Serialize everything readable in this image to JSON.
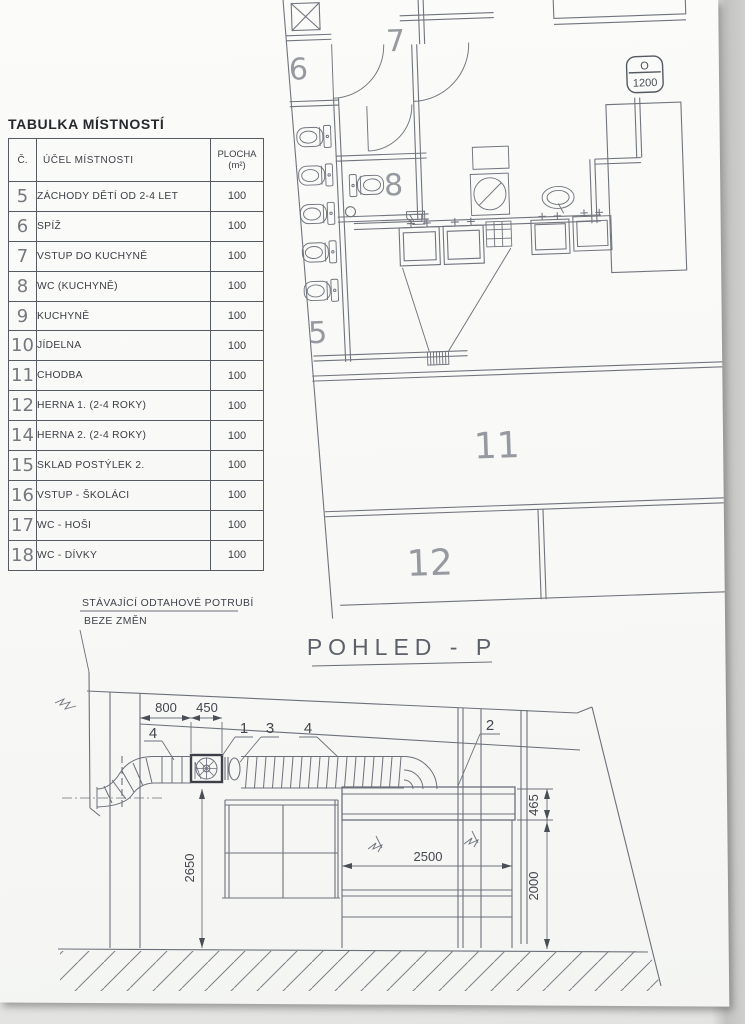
{
  "table": {
    "title": "TABULKA MÍSTNOSTÍ",
    "col_num": "Č.",
    "col_purpose": "ÚČEL MÍSTNOSTI",
    "col_area1": "PLOCHA",
    "col_area2": "(m²)",
    "rows": [
      {
        "num": "5",
        "purpose": "ZÁCHODY DĚTÍ OD 2-4 LET",
        "area": "100"
      },
      {
        "num": "6",
        "purpose": "SPÍŽ",
        "area": "100"
      },
      {
        "num": "7",
        "purpose": "VSTUP DO KUCHYNĚ",
        "area": "100"
      },
      {
        "num": "8",
        "purpose": "WC (KUCHYNĚ)",
        "area": "100"
      },
      {
        "num": "9",
        "purpose": "KUCHYNĚ",
        "area": "100"
      },
      {
        "num": "10",
        "purpose": "JÍDELNA",
        "area": "100"
      },
      {
        "num": "11",
        "purpose": "CHODBA",
        "area": "100"
      },
      {
        "num": "12",
        "purpose": "HERNA 1. (2-4 ROKY)",
        "area": "100"
      },
      {
        "num": "14",
        "purpose": "HERNA 2. (2-4 ROKY)",
        "area": "100"
      },
      {
        "num": "15",
        "purpose": "SKLAD POSTÝLEK 2.",
        "area": "100"
      },
      {
        "num": "16",
        "purpose": "VSTUP - ŠKOLÁCI",
        "area": "100"
      },
      {
        "num": "17",
        "purpose": "WC - HOŠI",
        "area": "100"
      },
      {
        "num": "18",
        "purpose": "WC - DÍVKY",
        "area": "100"
      }
    ]
  },
  "plan": {
    "rooms": {
      "r5": "5",
      "r6": "6",
      "r7": "7",
      "r8": "8",
      "r11": "11",
      "r12": "12"
    },
    "badge": {
      "top": "O",
      "bottom": "1200"
    }
  },
  "section": {
    "title": "POHLED - P",
    "note1": "STÁVAJÍCÍ ODTAHOVÉ POTRUBÍ",
    "note2": "BEZE ZMĚN",
    "dims": {
      "d800": "800",
      "d450": "450",
      "d465": "465",
      "d2500": "2500",
      "d2000": "2000",
      "d2650": "2650"
    },
    "callouts": {
      "c1": "1",
      "c2": "2",
      "c3": "3",
      "c4a": "4",
      "c4b": "4"
    }
  }
}
